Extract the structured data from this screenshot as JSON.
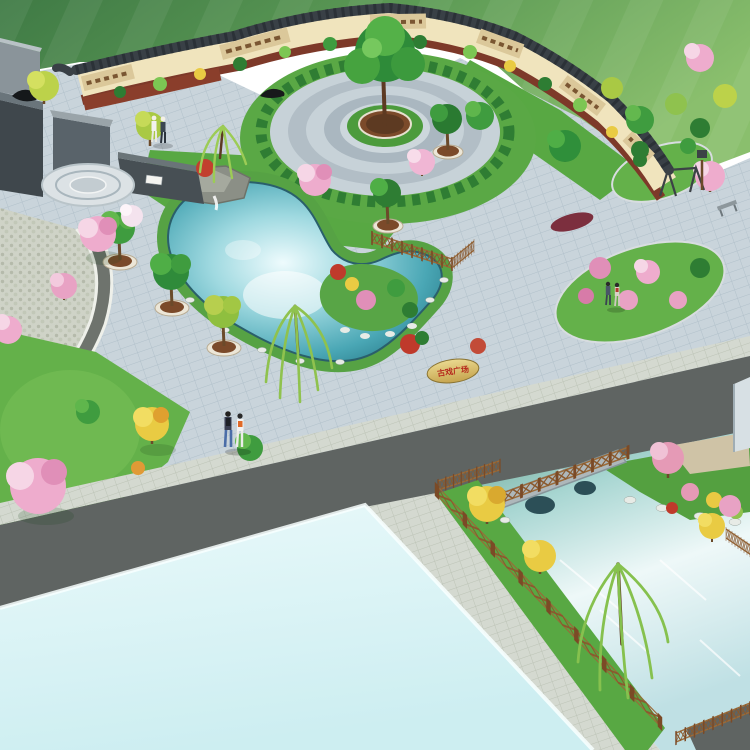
{
  "scene": {
    "type": "3D aerial landscape-architecture rendering",
    "subject": "Village cultural plaza and water-feature park enclosed by a curved Chinese mural screen wall",
    "view": "isometric bird's-eye",
    "inscription_stone": {
      "text": "古戏广场",
      "text_color": "#b5281c",
      "stone_color": "#e0c878"
    },
    "palette": {
      "field_green_dark": "#3f7a45",
      "field_green_light": "#8abf6d",
      "plaza_tile": "#c9d4db",
      "tile_line": "#b1c0ca",
      "apron_paving": "#d4d9d0",
      "road_asphalt": "#5f6462",
      "path_dark": "#6e736d",
      "wall_cream": "#f0e4bd",
      "wall_coping": "#394046",
      "wall_base_red": "#7e3a28",
      "mural_tan": "#dbc89a",
      "mural_brown": "#7a5632",
      "lawn_green": "#5fae46",
      "shrub_dark": "#2e7d33",
      "foliage_light": "#7cc653",
      "blossom_pink": "#eeaccd",
      "blossom_deep": "#e08fb8",
      "autumn_yellow": "#e9cb43",
      "red_shrub": "#bf3a2b",
      "willow_green": "#8fc24e",
      "pond_deep": "#1f6e7d",
      "pond_mid": "#6fc3cf",
      "pond_highlight": "#eefbfd",
      "pale_water_plane": "#def3f5",
      "planter_brown": "#7b4a2a",
      "planter_rim": "#ece6d7",
      "fence_brown": "#8a5a2e",
      "bridge_grey": "#aab3b6",
      "rock_white": "#e7ebe6",
      "monument_grey": "#76838a"
    },
    "features": [
      {
        "id": "mowed-field",
        "label": "Striped green lawn field in the background"
      },
      {
        "id": "mural-wall",
        "label": "Curved cream screen wall with dark tile coping and brown relief murals"
      },
      {
        "id": "monument",
        "label": "Grey stone memorial walls with black sculpture at the north-west corner"
      },
      {
        "id": "circular-plaza",
        "label": "Concentric-ring paved circle with a large tree in a central planter"
      },
      {
        "id": "main-pond",
        "label": "Kidney-shaped pond with rockery waterfall, island and grass banks"
      },
      {
        "id": "feature-wall",
        "label": "Dark landscape feature wall with a small white name plaque"
      },
      {
        "id": "inscription-stone",
        "label": "Yellow boulder engraved with four red characters"
      },
      {
        "id": "planter-trees",
        "label": "Trees set in round brown planters with pale rims along the pond"
      },
      {
        "id": "timber-fences",
        "label": "Brown timber cross-rail fences along pond and stream"
      },
      {
        "id": "stone-bridge",
        "label": "Grey stone arch bridge over the stream"
      },
      {
        "id": "stream-garden",
        "label": "Fenced stream garden with willows, golden and blossom trees and white rocks"
      },
      {
        "id": "asphalt-road",
        "label": "Dark asphalt road crossing the lower part of the site"
      },
      {
        "id": "pale-water-plane",
        "label": "Large pale reflective water plane at the lower left"
      },
      {
        "id": "lawn-ovals",
        "label": "Oval lawns with pink blossom shrubs on the east side"
      },
      {
        "id": "site-furniture",
        "label": "Swing frame, lamp post and metal bench on the east lawns"
      },
      {
        "id": "pedestrians",
        "label": "Three pairs of strolling visitors"
      }
    ],
    "people": [
      {
        "id": "pair-a",
        "location": "upper plaza in front of the mural wall",
        "outfits": [
          "white suit and hat",
          "dark top, white hat"
        ]
      },
      {
        "id": "pair-b",
        "location": "lower central plaza",
        "outfits": [
          "navy striped top, jeans, black backpack",
          "white outfit with orange backpack"
        ]
      },
      {
        "id": "pair-c",
        "location": "east path beside the lawn ovals",
        "outfits": [
          "dark outfit",
          "light top with red bag"
        ]
      }
    ]
  }
}
